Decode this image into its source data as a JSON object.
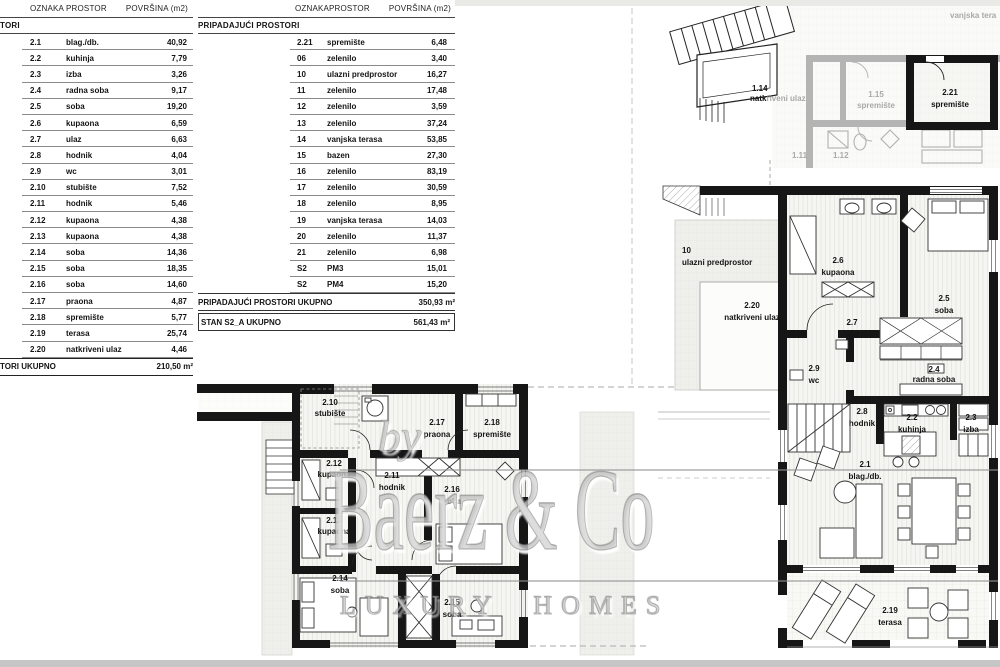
{
  "tables": {
    "left": {
      "headers": {
        "c1": "OZNAKA",
        "c2": "PROSTOR",
        "c3": "POVRŠINA (m2)"
      },
      "section_label": "TORI",
      "rows": [
        [
          "2.1",
          "blag./db.",
          "40,92"
        ],
        [
          "2.2",
          "kuhinja",
          "7,79"
        ],
        [
          "2.3",
          "izba",
          "3,26"
        ],
        [
          "2.4",
          "radna soba",
          "9,17"
        ],
        [
          "2.5",
          "soba",
          "19,20"
        ],
        [
          "2.6",
          "kupaona",
          "6,59"
        ],
        [
          "2.7",
          "ulaz",
          "6,63"
        ],
        [
          "2.8",
          "hodnik",
          "4,04"
        ],
        [
          "2.9",
          "wc",
          "3,01"
        ],
        [
          "2.10",
          "stubište",
          "7,52"
        ],
        [
          "2.11",
          "hodnik",
          "5,46"
        ],
        [
          "2.12",
          "kupaona",
          "4,38"
        ],
        [
          "2.13",
          "kupaona",
          "4,38"
        ],
        [
          "2.14",
          "soba",
          "14,36"
        ],
        [
          "2.15",
          "soba",
          "18,35"
        ],
        [
          "2.16",
          "soba",
          "14,60"
        ],
        [
          "2.17",
          "praona",
          "4,87"
        ],
        [
          "2.18",
          "spremište",
          "5,77"
        ],
        [
          "2.19",
          "terasa",
          "25,74"
        ],
        [
          "2.20",
          "natkriveni ulaz",
          "4,46"
        ]
      ],
      "total_label": "TORI UKUPNO",
      "total_value": "210,50 m²"
    },
    "right": {
      "headers": {
        "c1": "OZNAKA",
        "c2": "PROSTOR",
        "c3": "POVRŠINA (m2)"
      },
      "section_label": "PRIPADAJUĆI PROSTORI",
      "rows": [
        [
          "2.21",
          "spremište",
          "6,48"
        ],
        [
          "06",
          "zelenilo",
          "3,40"
        ],
        [
          "10",
          "ulazni predprostor",
          "16,27"
        ],
        [
          "11",
          "zelenilo",
          "17,48"
        ],
        [
          "12",
          "zelenilo",
          "3,59"
        ],
        [
          "13",
          "zelenilo",
          "37,24"
        ],
        [
          "14",
          "vanjska terasa",
          "53,85"
        ],
        [
          "15",
          "bazen",
          "27,30"
        ],
        [
          "16",
          "zelenilo",
          "83,19"
        ],
        [
          "17",
          "zelenilo",
          "30,59"
        ],
        [
          "18",
          "zelenilo",
          "8,95"
        ],
        [
          "19",
          "vanjska terasa",
          "14,03"
        ],
        [
          "20",
          "zelenilo",
          "11,37"
        ],
        [
          "21",
          "zelenilo",
          "6,98"
        ],
        [
          "S2",
          "PM3",
          "15,01"
        ],
        [
          "S2",
          "PM4",
          "15,20"
        ]
      ],
      "total_label": "PRIPADAJUĆI PROSTORI UKUPNO",
      "total_value": "350,93 m²",
      "grand_total_label": "STAN S2_A UKUPNO",
      "grand_total_value": "561,43 m²"
    }
  },
  "watermark": {
    "prefix": "by",
    "brand": "Baerz & Co",
    "tagline": "LUXURY HOMES"
  },
  "plan_upper": {
    "terrace_label": "vanjska tera",
    "rooms": {
      "r114": {
        "num": "1.14",
        "name_bold": "natk",
        "name_gray": "riveni ulaz"
      },
      "r115": {
        "num": "1.15",
        "name": "spremište"
      },
      "r221": {
        "num": "2.21",
        "name": "spremište"
      },
      "r111": {
        "num": "1.11"
      },
      "r112": {
        "num": "1.12"
      }
    }
  },
  "plan_main": {
    "rooms": {
      "r10": {
        "num": "10",
        "name": "ulazni predprostor"
      },
      "r220": {
        "num": "2.20",
        "name": "natkriveni ulaz"
      },
      "r26": {
        "num": "2.6",
        "name": "kupaona"
      },
      "r25": {
        "num": "2.5",
        "name": "soba"
      },
      "r27": {
        "num": "2.7",
        "name": "ulaz"
      },
      "r29": {
        "num": "2.9",
        "name": "wc"
      },
      "r24": {
        "num": "2.4",
        "name": "radna soba"
      },
      "r28": {
        "num": "2.8",
        "name": "hodnik"
      },
      "r22": {
        "num": "2.2",
        "name": "kuhinja"
      },
      "r23": {
        "num": "2.3",
        "name": "izba"
      },
      "r21": {
        "num": "2.1",
        "name": "blag./db."
      },
      "r219": {
        "num": "2.19",
        "name": "terasa"
      }
    }
  },
  "plan_lower": {
    "rooms": {
      "r210": {
        "num": "2.10",
        "name": "stubište"
      },
      "r217": {
        "num": "2.17",
        "name": "praona"
      },
      "r218": {
        "num": "2.18",
        "name": "spremište"
      },
      "r212": {
        "num": "2.12",
        "name": "kupaona"
      },
      "r213": {
        "num": "2.13",
        "name": "kupaona"
      },
      "r211": {
        "num": "2.11",
        "name": "hodnik"
      },
      "r216": {
        "num": "2.16",
        "name": "soba"
      },
      "r214": {
        "num": "2.14",
        "name": "soba"
      },
      "r215": {
        "num": "2.15",
        "name": "soba"
      }
    }
  },
  "colors": {
    "wall": "#161616",
    "gray_wall": "#b4b4b4",
    "gray_label": "#a9a9a9",
    "footer_bar": "#c6c6c6",
    "watermark": "#cdcdcd"
  }
}
